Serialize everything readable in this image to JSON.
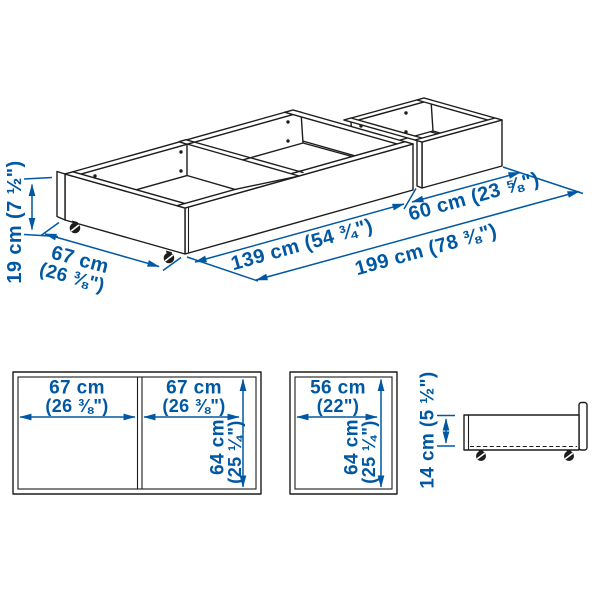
{
  "colors": {
    "accent": "#0058a3",
    "line": "#1d1d1b"
  },
  "iso_view": {
    "height_label": "19 cm (7 ½\")",
    "depth_label_line1": "67 cm",
    "depth_label_line2": "(26 ⅜\")",
    "main_box_length_label": "139 cm (54 ¾\")",
    "second_box_length_label": "60 cm (23 ⅝\")",
    "total_length_label": "199 cm (78 ⅜\")"
  },
  "top_view_large": {
    "left_compartment_width_line1": "67 cm",
    "left_compartment_width_line2": "(26 ⅜\")",
    "right_compartment_width_line1": "67 cm",
    "right_compartment_width_line2": "(26 ⅜\")",
    "depth_line1": "64 cm",
    "depth_line2": "(25 ¼\")"
  },
  "top_view_small": {
    "width_line1": "56 cm",
    "width_line2": "(22\")",
    "depth_line1": "64 cm",
    "depth_line2": "(25 ¼\")"
  },
  "side_view": {
    "height_label": "14 cm (5 ½\")"
  }
}
